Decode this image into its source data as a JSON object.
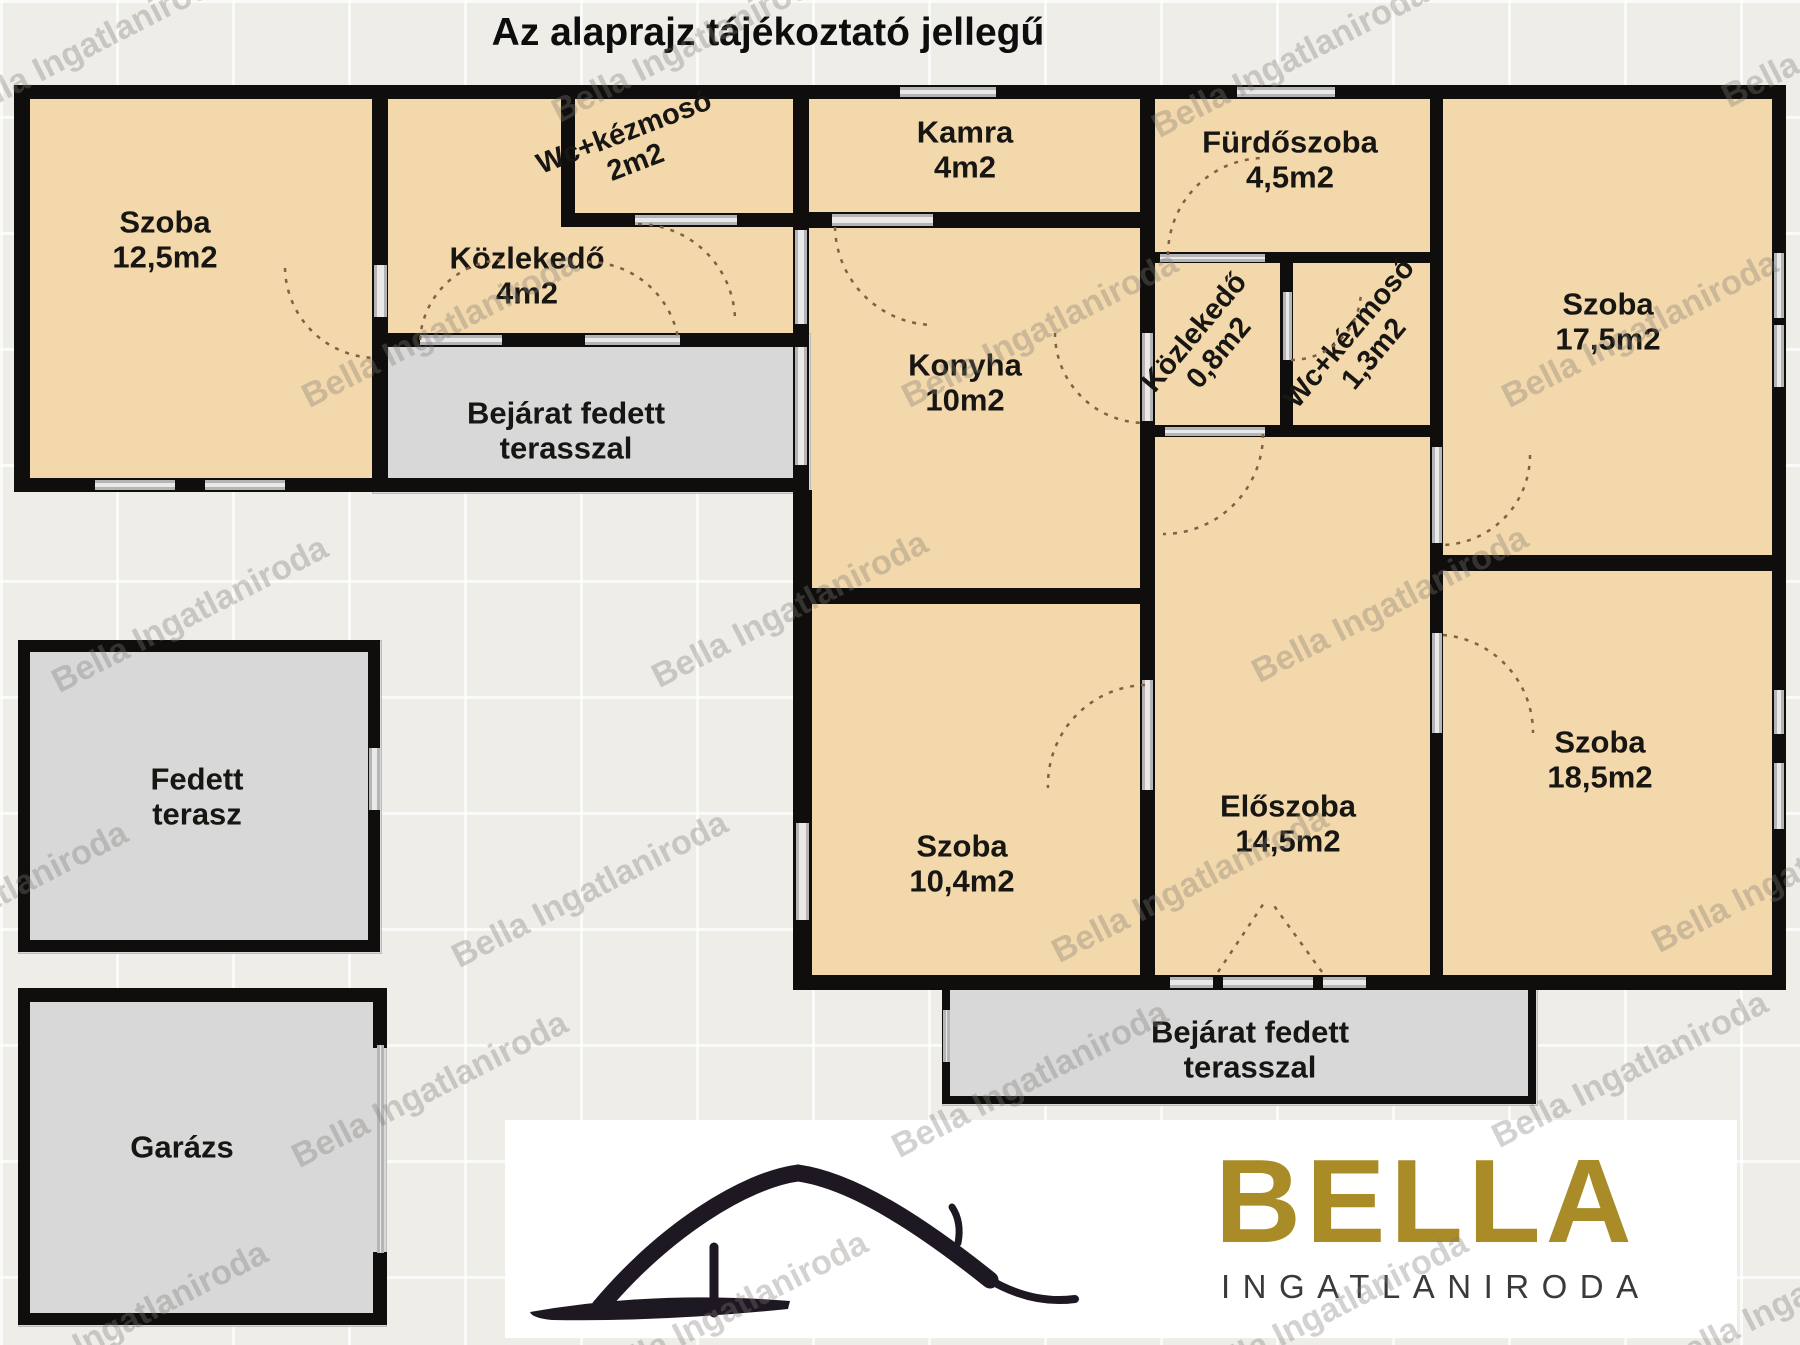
{
  "title": "Az alaprajz tájékoztató jellegű",
  "watermark": {
    "text": "Bella Ingatlaniroda"
  },
  "colors": {
    "background": "#efede8",
    "room_fill": "#f2d8ab",
    "terrace_fill": "#d8d8d8",
    "wall": "#0f0e0c",
    "door_arc": "#826043",
    "logo_gold": "#a98b28",
    "logo_dark": "#1e1822"
  },
  "rooms": {
    "szoba_top_left": {
      "name": "Szoba",
      "area": "12,5m2"
    },
    "wc_kezmoso_2": {
      "name": "Wc+kézmosó",
      "area": "2m2"
    },
    "kozlekedo_4": {
      "name": "Közlekedő",
      "area": "4m2"
    },
    "kamra": {
      "name": "Kamra",
      "area": "4m2"
    },
    "furdoszoba": {
      "name": "Fürdőszoba",
      "area": "4,5m2"
    },
    "konyha": {
      "name": "Konyha",
      "area": "10m2"
    },
    "kozlekedo_08": {
      "name": "Közlekedő",
      "area": "0,8m2"
    },
    "wc_kezmoso_13": {
      "name": "Wc+kézmosó",
      "area": "1,3m2"
    },
    "szoba_top_right": {
      "name": "Szoba",
      "area": "17,5m2"
    },
    "szoba_middle": {
      "name": "Szoba",
      "area": "10,4m2"
    },
    "eloszoba": {
      "name": "Előszoba",
      "area": "14,5m2"
    },
    "szoba_bottom_right": {
      "name": "Szoba",
      "area": "18,5m2"
    },
    "bejarat_felso": {
      "line1": "Bejárat fedett",
      "line2": "terasszal"
    },
    "fedett_terasz": {
      "line1": "Fedett",
      "line2": "terasz"
    },
    "garazs": {
      "name": "Garázs"
    },
    "bejarat_also": {
      "line1": "Bejárat fedett",
      "line2": "terasszal"
    }
  },
  "logo": {
    "brand": "BELLA",
    "subtitle": "INGATLANIRODA"
  }
}
